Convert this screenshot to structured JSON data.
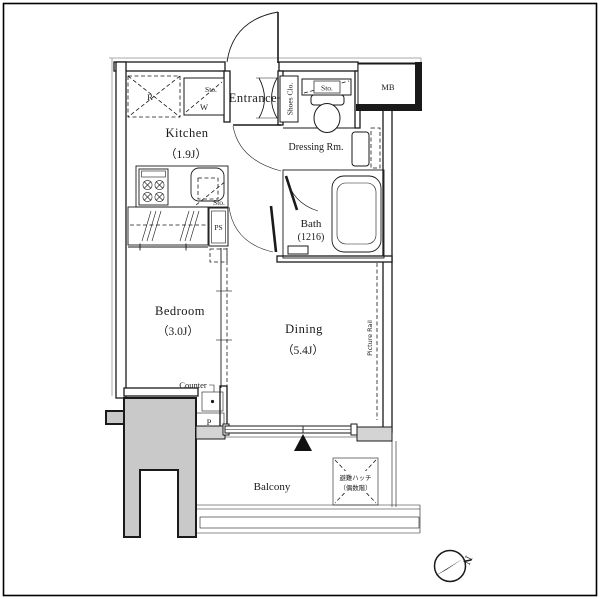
{
  "rooms": {
    "kitchen": {
      "name": "Kitchen",
      "size": "（1.9J）"
    },
    "bedroom": {
      "name": "Bedroom",
      "size": "（3.0J）"
    },
    "dining": {
      "name": "Dining",
      "size": "（5.4J）"
    },
    "bath": {
      "name": "Bath",
      "size": "(1216)"
    },
    "dressing": {
      "name": "Dressing Rm."
    },
    "entrance": {
      "name": "Entrance"
    },
    "balcony": {
      "name": "Balcony"
    }
  },
  "labels": {
    "refrigerator": "R",
    "washer": "W",
    "sto_washer": "Sto.",
    "sto_sink": "Sto.",
    "sto_toilet": "Sto.",
    "shoes_closet": "Shoes Clo.",
    "meter_box": "MB",
    "pipe_space": "PS",
    "pole": "P",
    "counter": "Counter",
    "picture_rail": "Picture Rail",
    "hatch_line1": "避難ハッチ",
    "hatch_line2": "（偶数階）",
    "compass_north": "N"
  },
  "colors": {
    "wall": "#1a1a1a",
    "column_fill": "#c9c9c9",
    "stub_fill": "#d4d4d4",
    "outline": "#aaaaaa"
  }
}
